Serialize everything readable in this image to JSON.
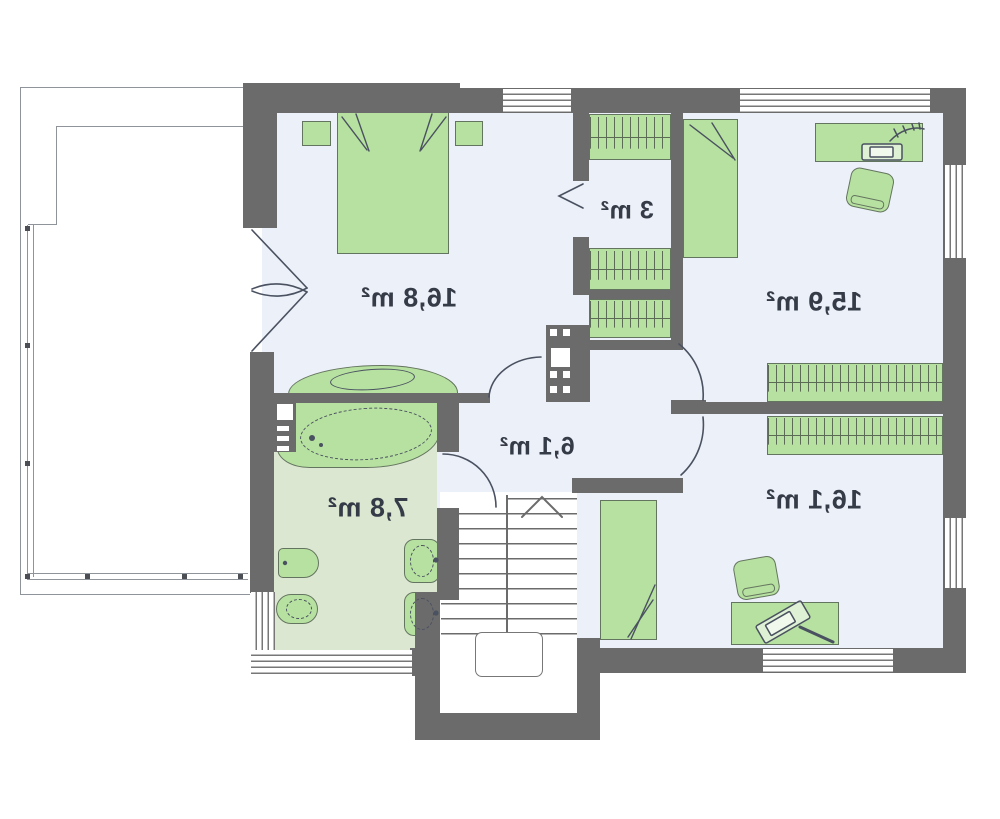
{
  "plan": {
    "type": "architectural-floor-plan",
    "text_mirrored": true,
    "rooms": [
      {
        "id": "room-top-left-bedroom",
        "area_label": "16,8 m²"
      },
      {
        "id": "room-closet",
        "area_label": "3 m²"
      },
      {
        "id": "room-top-right",
        "area_label": "15,9 m²"
      },
      {
        "id": "room-hall",
        "area_label": "6,1 m²"
      },
      {
        "id": "room-bathroom",
        "area_label": "7,8 m²"
      },
      {
        "id": "room-bottom-right",
        "area_label": "16,1 m²"
      }
    ],
    "colors": {
      "wall": "#6b6b6b",
      "floor": "#ecf0f8",
      "bath_floor": "#dce7d2",
      "furniture": "#b7e1a0",
      "furniture_border": "#64755f",
      "hatch_line": "#5c6b55",
      "line": "#4a5160",
      "terrace_line": "#8f949a",
      "window_line": "#777777",
      "label": "#353b47"
    }
  }
}
